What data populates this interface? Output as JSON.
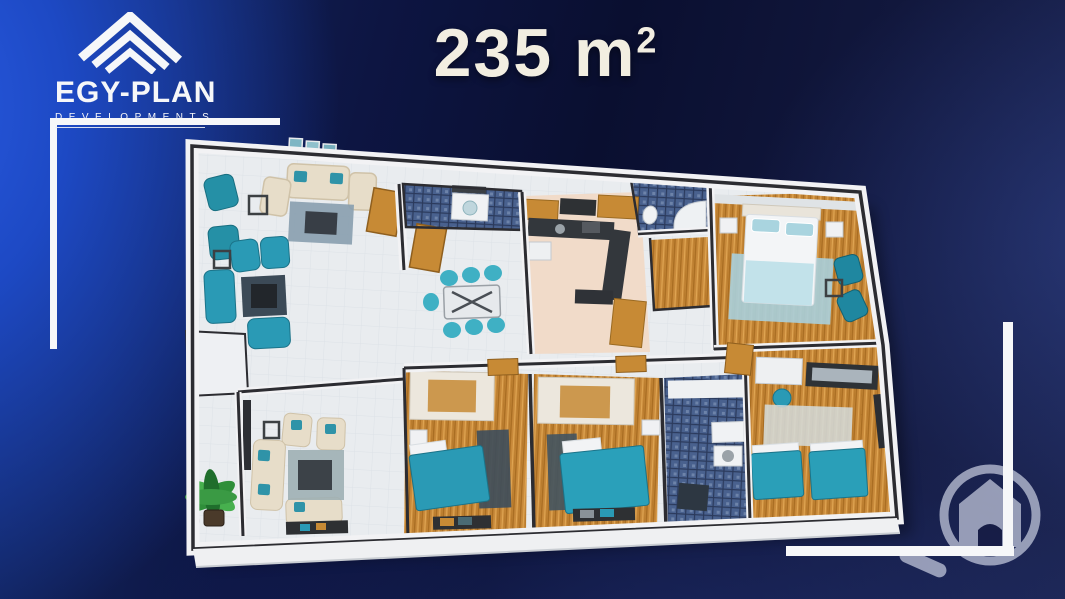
{
  "brand": {
    "name": "EGY-PLAN",
    "subtitle": "DEVELOPMENTS",
    "logo_icon": "triple-chevron-roof-icon"
  },
  "area_title": {
    "value": "235",
    "unit": "m",
    "exponent": "2"
  },
  "watermark": {
    "icon": "house-in-circle-icon"
  },
  "colors": {
    "background_bright_blue": "#2a5ce4",
    "background_navy": "#0a0f30",
    "frame_white": "#f6f7f9",
    "title_cream": "#f2eee1",
    "wall_white": "#f2f2f4",
    "wall_dark_line": "#2c2c31",
    "floor_tile": "#e9ecef",
    "floor_wood": "#c8893a",
    "floor_terracotta": "#f1dbc9",
    "bathroom_mosaic": "#49618e",
    "furniture_teal": "#2a9ab5",
    "furniture_beige": "#e7ddc9",
    "rug_blue_gray": "#8aa0b0",
    "plant_green": "#3a9a44"
  },
  "floor_plan": {
    "rooms": [
      {
        "id": "living-dining-room",
        "floor": "light-tile"
      },
      {
        "id": "dining-area",
        "floor": "light-tile"
      },
      {
        "id": "kitchen",
        "floor": "terracotta"
      },
      {
        "id": "bathroom-top",
        "floor": "blue-mosaic"
      },
      {
        "id": "bathroom-shower",
        "floor": "blue-mosaic"
      },
      {
        "id": "bathroom-bottom",
        "floor": "blue-mosaic"
      },
      {
        "id": "entrance-foyer",
        "floor": "wood"
      },
      {
        "id": "master-bedroom",
        "floor": "wood"
      },
      {
        "id": "bedroom-a",
        "floor": "wood"
      },
      {
        "id": "bedroom-b",
        "floor": "wood"
      },
      {
        "id": "twin-bedroom",
        "floor": "wood"
      },
      {
        "id": "salon",
        "floor": "light-tile"
      },
      {
        "id": "balcony",
        "floor": "light-tile"
      }
    ]
  }
}
